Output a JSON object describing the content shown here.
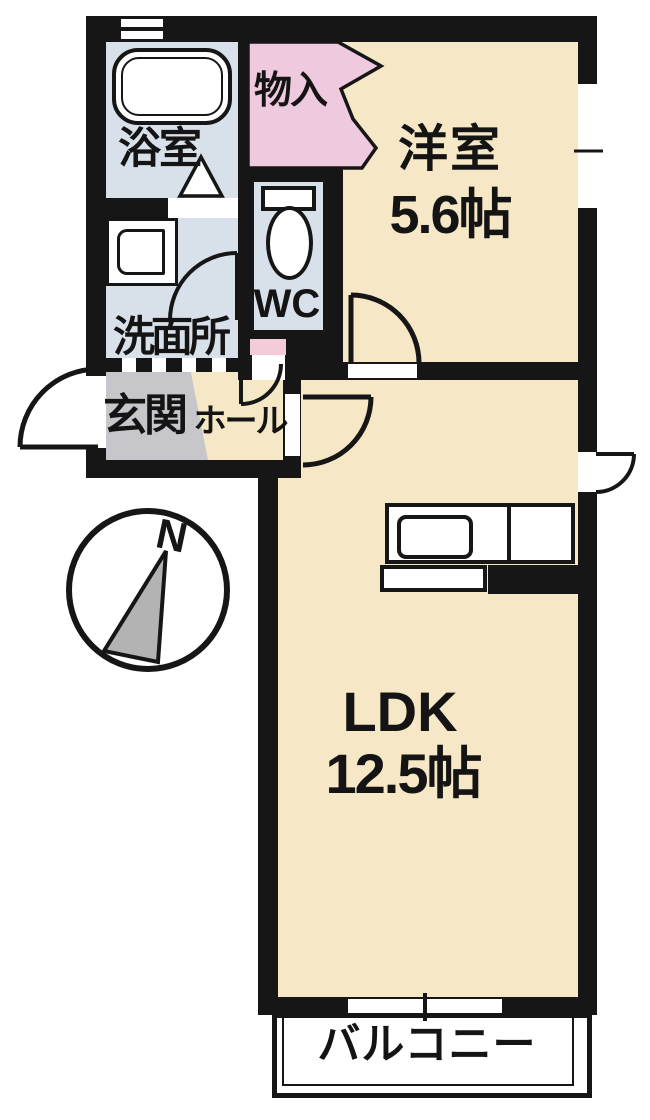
{
  "plan": {
    "rooms": {
      "bath": "浴室",
      "storage": "物入",
      "western_room": {
        "name": "洋室",
        "size": "5.6帖"
      },
      "toilet": "WC",
      "washroom": "洗面所",
      "entrance": "玄関",
      "entrance_hall": "ホール",
      "ldk": {
        "name": "LDK",
        "size": "12.5帖"
      },
      "balcony": "バルコニー"
    },
    "compass": {
      "north": "N"
    },
    "colors": {
      "floor_cream": "#F6E7C6",
      "wet_area_blue": "#D8E1EA",
      "closet_pink": "#EFC9DD",
      "step_pink": "#F3CBD9",
      "entrance_gray": "#C7C7CB",
      "wall_black": "#161616",
      "needle_gray": "#B3B3B3"
    }
  }
}
